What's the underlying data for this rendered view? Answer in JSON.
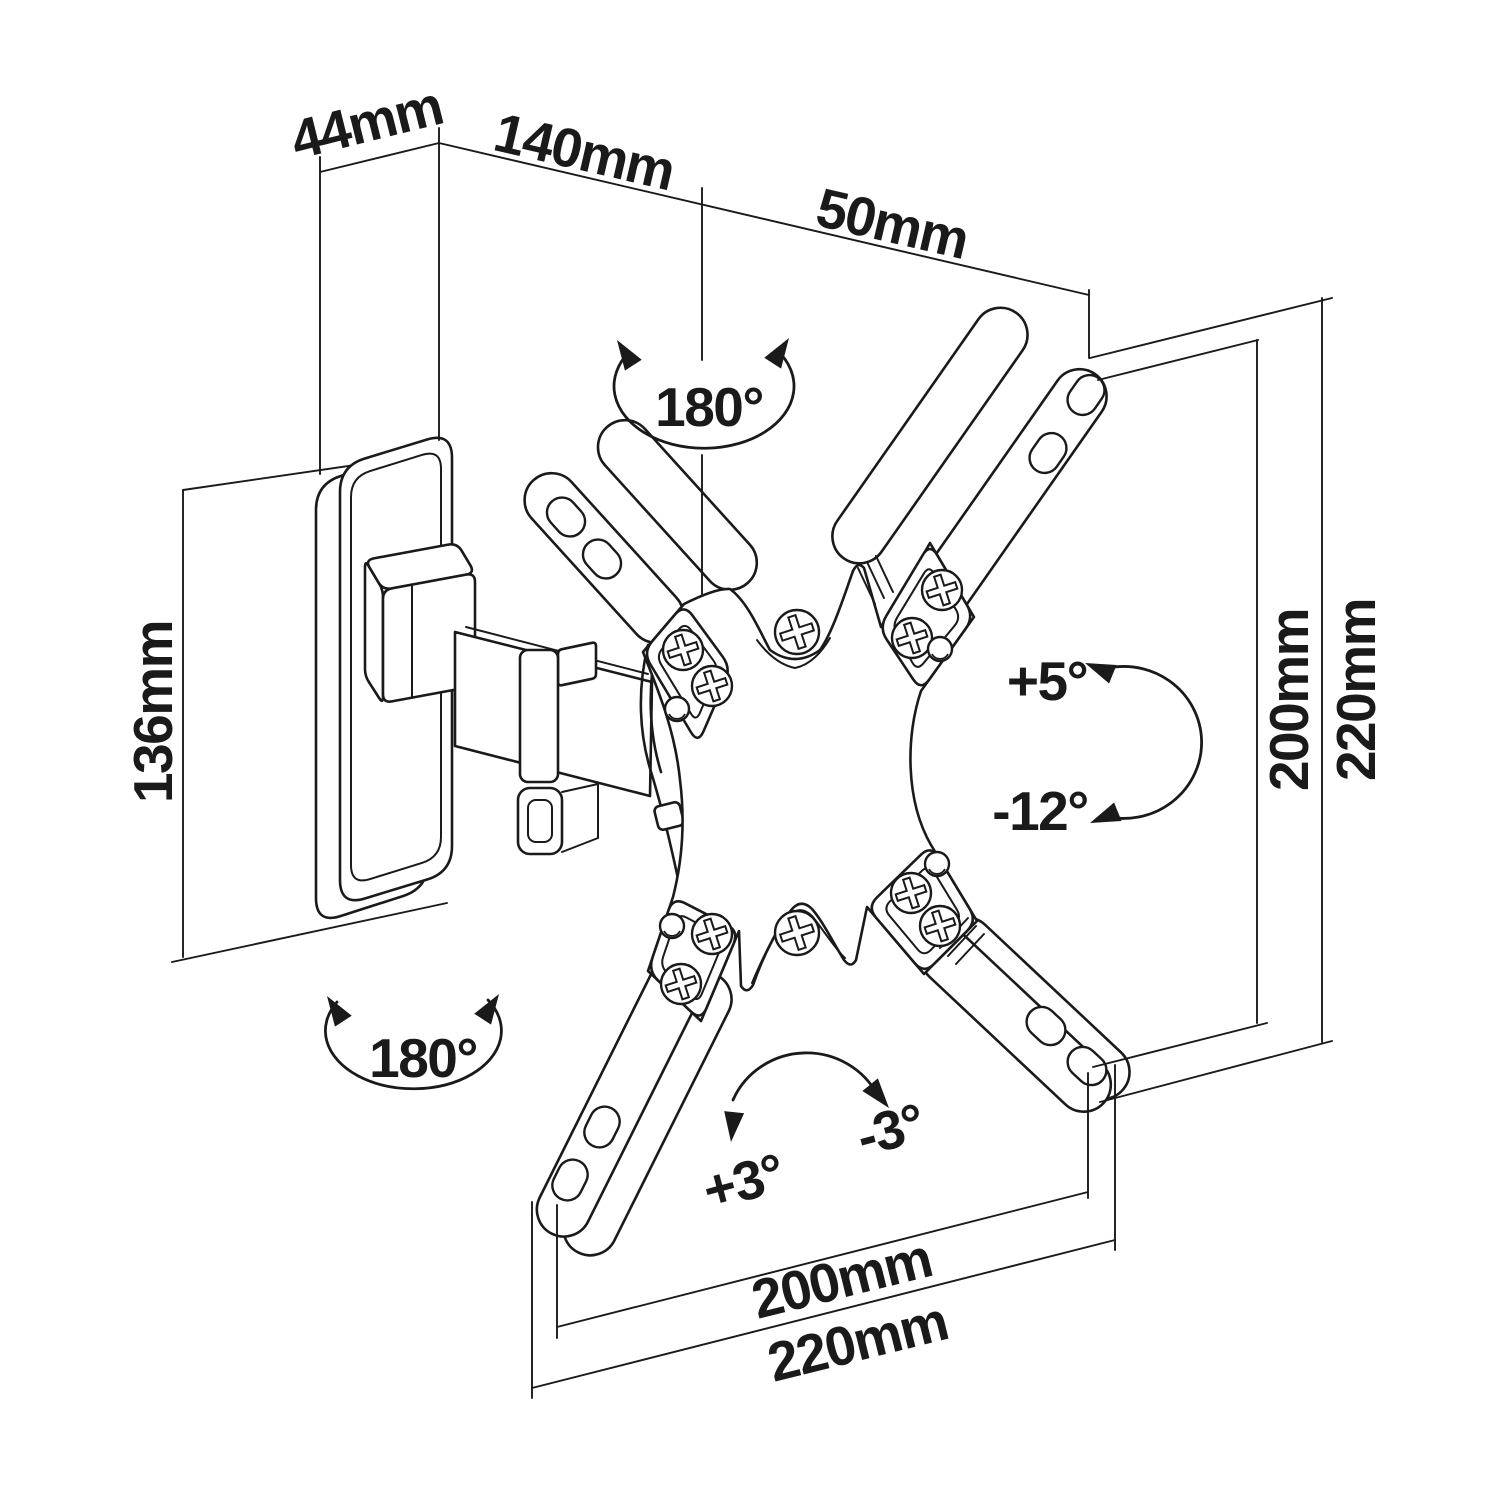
{
  "drawing": {
    "dimensions": {
      "wall_plate_depth": "44mm",
      "arm_length": "140mm",
      "head_offset": "50mm",
      "wall_plate_height": "136mm",
      "vesa_height": "200mm",
      "plate_outer_height": "220mm",
      "vesa_width": "200mm",
      "plate_outer_width": "220mm"
    },
    "angles": {
      "swivel_arm": "180°",
      "swivel_base": "180°",
      "tilt_up": "+5°",
      "tilt_down": "-12°",
      "level_cw": "+3°",
      "level_ccw": "-3°"
    },
    "colors": {
      "line": "#1a1a1a",
      "background": "#ffffff"
    }
  }
}
